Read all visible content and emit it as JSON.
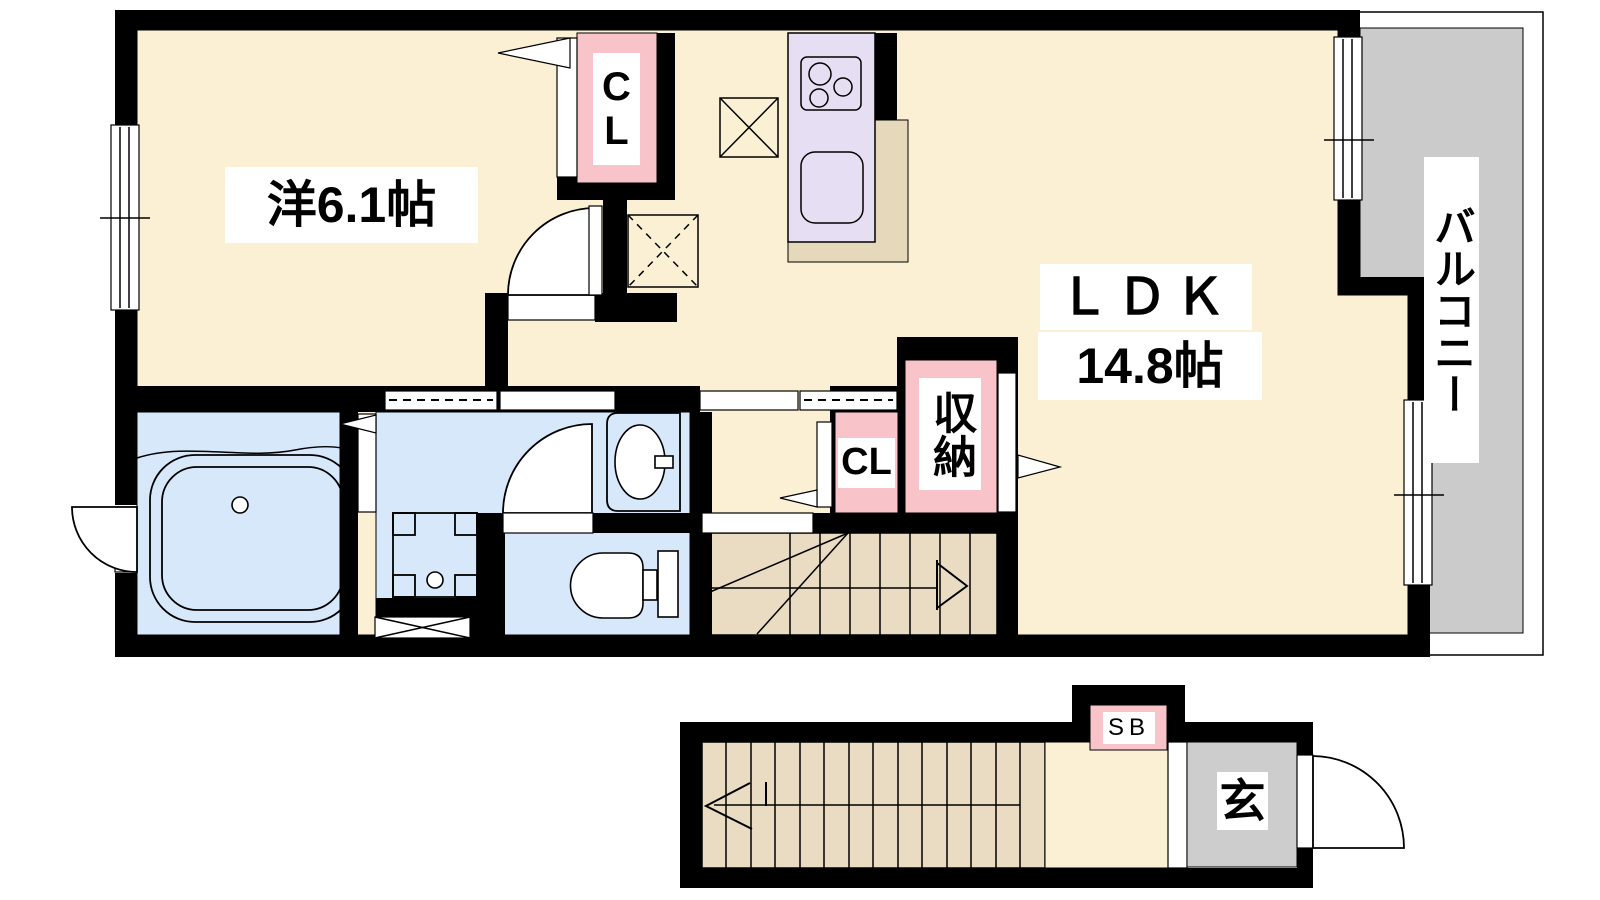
{
  "title": "Japanese apartment floor plan (2-story maisonette)",
  "colors": {
    "page_bg": "#ffffff",
    "wall": "#000000",
    "room_floor": "#FBF0D3",
    "wet_floor": "#D8E8FB",
    "closet": "#F8C3C9",
    "kitchen_counter": "#E6DFF3",
    "kitchen_floor": "#E6D8BB",
    "stairs": "#EADCC2",
    "balcony": "#CBCBCB",
    "entrance_floor": "#CDCDCD"
  },
  "floor2": {
    "western_room_label": "洋6.1帖",
    "ldk_name": "ＬＤＫ",
    "ldk_size": "14.8帖",
    "closet_upper_label": "CL",
    "closet_lower_label": "CL",
    "storage_label": "収納",
    "balcony_label": "バルコニー"
  },
  "floor1": {
    "shoe_box_label": "SB",
    "entrance_label": "玄"
  }
}
